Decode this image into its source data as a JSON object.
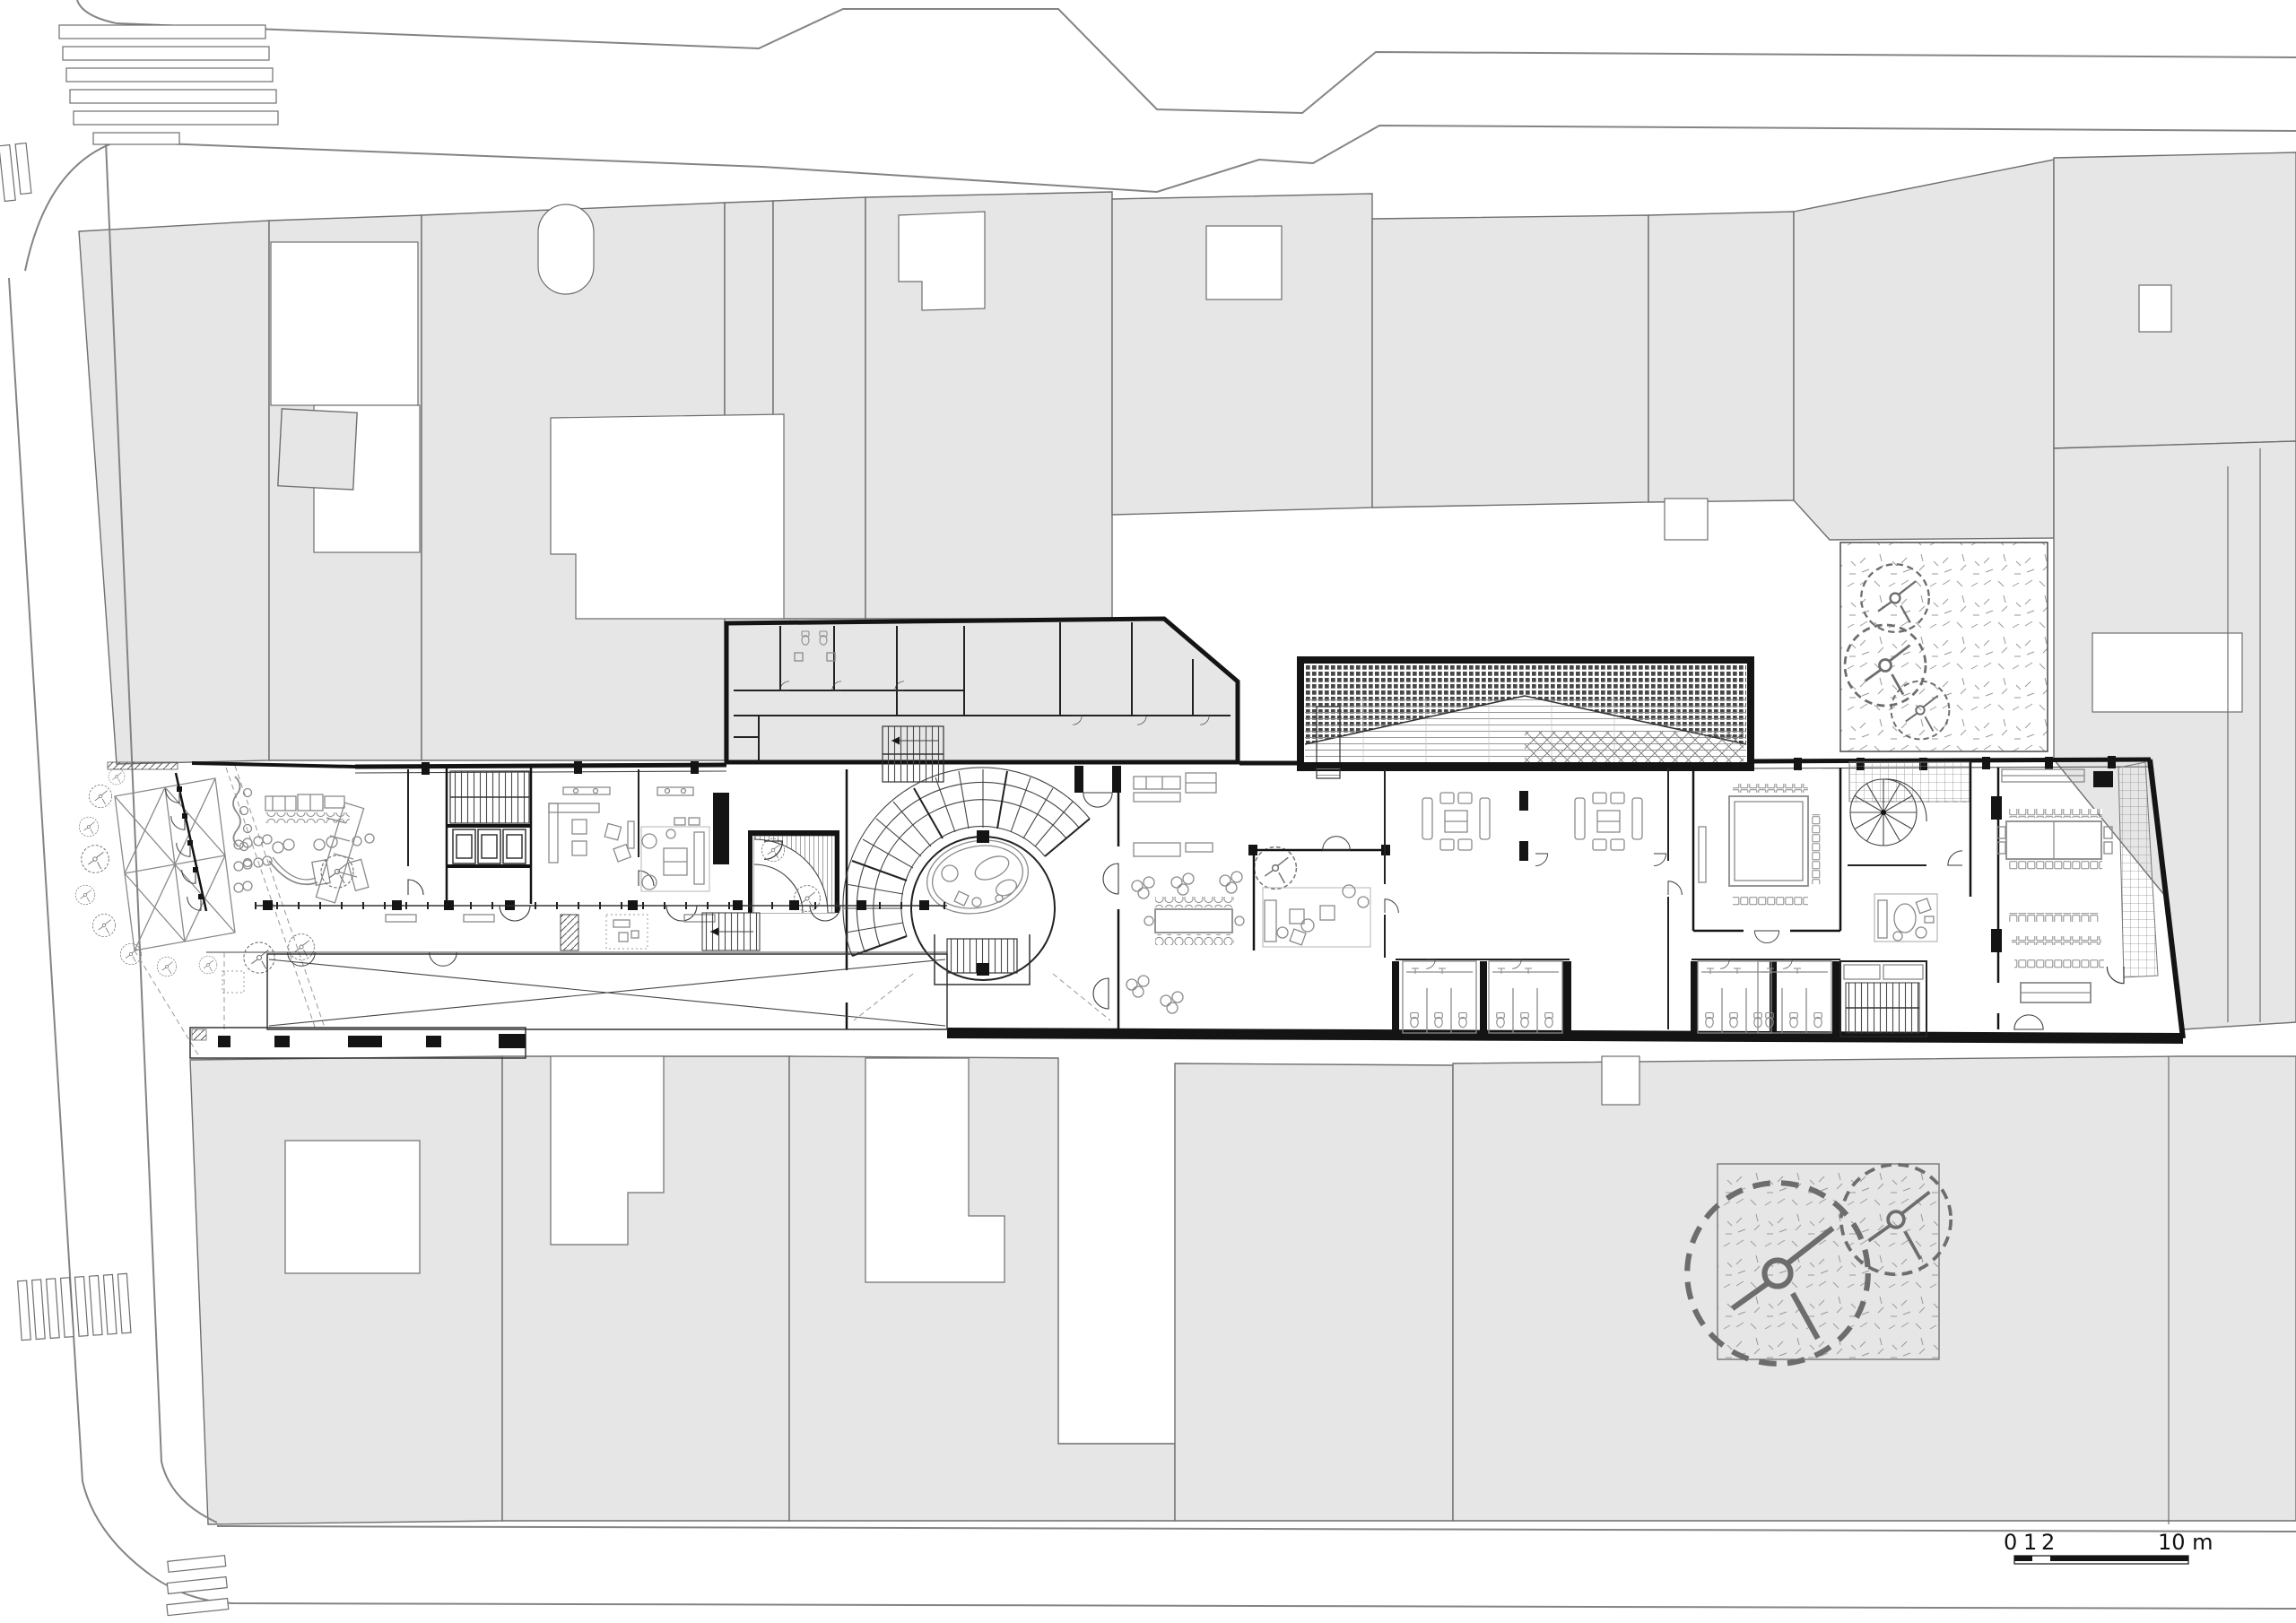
{
  "scale_bar": {
    "ticks": [
      "0",
      "1",
      "2"
    ],
    "max_label": "10 m"
  },
  "colors": {
    "paper": "#ffffff",
    "block-fill": "#e6e6e6",
    "block-stroke": "#6f6f6f",
    "ink": "#141414",
    "furn": "#8a8a8a",
    "mid": "#555555",
    "light": "#9a9a9a"
  }
}
